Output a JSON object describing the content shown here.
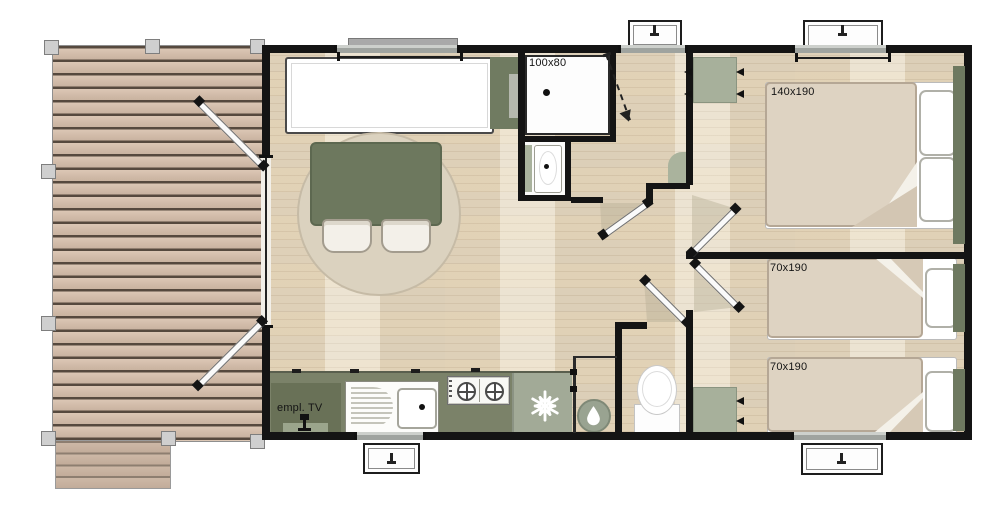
{
  "plan": {
    "labels": {
      "shower_size": "100x80",
      "double_bed_size": "140x190",
      "single_bed_top_size": "70x190",
      "single_bed_bottom_size": "70x190",
      "tv_spot": "empl. TV"
    },
    "colors": {
      "wall": "#141414",
      "furniture_green_dark": "#6e7960",
      "sage_green": "#a7b09b",
      "counter_green": "#7b8269",
      "fridge_green": "#a2aa97",
      "deck_plank": "#d4bfac",
      "floor_wood": "#ebe0ca",
      "rug_beige": "#dbd2bf",
      "duvet_beige": "#ded3c2"
    },
    "icons": {
      "fridge": "snowflake-icon",
      "water_heater": "water-drop-icon",
      "tv": "tv-icon",
      "windows": "window-handle-icon"
    }
  }
}
